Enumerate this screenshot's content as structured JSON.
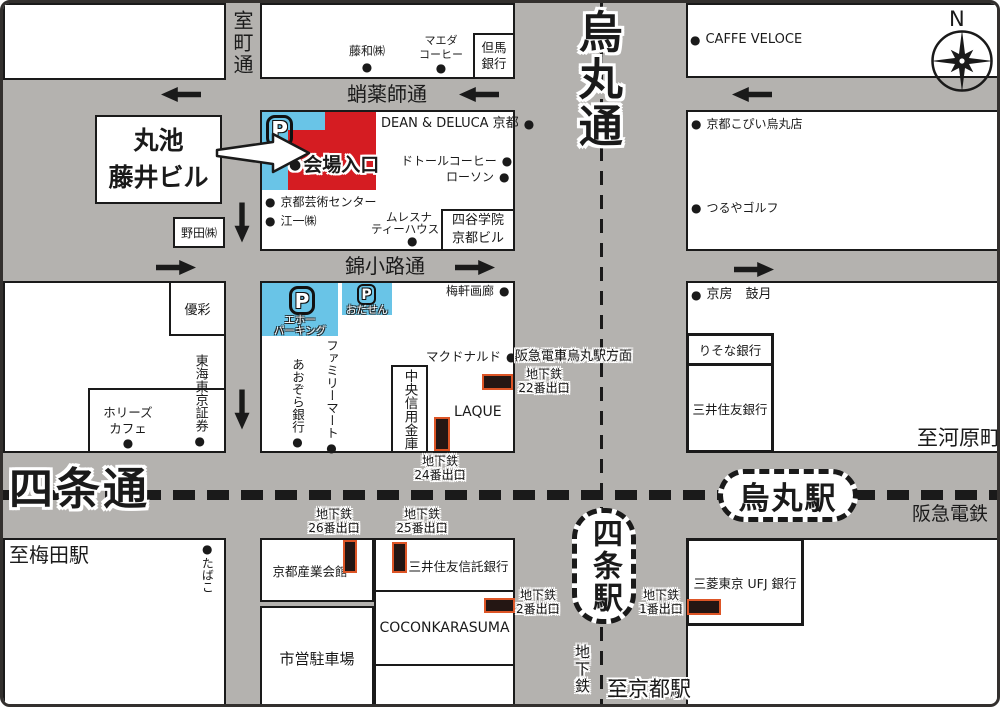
{
  "colors": {
    "road": "#b4b2af",
    "block": "#ffffff",
    "line": "#1a1a1a",
    "venue_red": "#d51c22",
    "parking_blue": "#69c4e7",
    "exit_marker_fill": "#241613",
    "exit_marker_border": "#dd5526"
  },
  "glyphs": {
    "bullet": "●",
    "parking": "P"
  },
  "compass": {
    "north": "N"
  },
  "streets": {
    "muromachi": "室町通",
    "takoyakushi": "蛸薬師通",
    "nishikikoji": "錦小路通",
    "karasuma": "烏丸通",
    "shijo": "四条通"
  },
  "railways": {
    "hankyu": "阪急電鉄",
    "hankyu_direction": "阪急電車烏丸駅方面",
    "subway": "地下鉄"
  },
  "stations": {
    "karasuma": "烏丸駅",
    "shijo": "四条駅"
  },
  "directions": {
    "to_kawaramachi": "至河原町",
    "to_umeda": "至梅田駅",
    "to_kyoto": "至京都駅"
  },
  "venue": {
    "building_l1": "丸池",
    "building_l2": "藤井ビル",
    "entrance": "会場入口"
  },
  "parkings": {
    "eho_l1": "エホー",
    "eho_l2": "パーキング",
    "odasen": "おだせん"
  },
  "subway_exits": {
    "e22": {
      "l1": "地下鉄",
      "l2": "22番出口"
    },
    "e24": {
      "l1": "地下鉄",
      "l2": "24番出口"
    },
    "e25": {
      "l1": "地下鉄",
      "l2": "25番出口"
    },
    "e26": {
      "l1": "地下鉄",
      "l2": "26番出口"
    },
    "e2": {
      "l1": "地下鉄",
      "l2": "2番出口"
    },
    "e1": {
      "l1": "地下鉄",
      "l2": "1番出口"
    }
  },
  "landmarks": {
    "towa": "藤和㈱",
    "maeda_l1": "マエダ",
    "maeda_l2": "コーヒー",
    "tajima_l1": "但馬",
    "tajima_l2": "銀行",
    "dean_deluca": "DEAN & DELUCA 京都",
    "doutor": "ドトールコーヒー",
    "lawson": "ローソン",
    "kyoto_art_center": "京都芸術センター",
    "koichi": "江一㈱",
    "mlesna_l1": "ムレスナ",
    "mlesna_l2": "ティーハウス",
    "yotsuya_l1": "四谷学院",
    "yotsuya_l2": "京都ビル",
    "noda": "野田㈱",
    "caffe_veloce": "CAFFE VELOCE",
    "kyoto_kopii": "京都こぴい烏丸店",
    "tsuruya_golf": "つるやゴルフ",
    "yusai": "優彩",
    "tokai_tokyo": "東海東京証券",
    "hollys_l1": "ホリーズ",
    "hollys_l2": "カフェ",
    "baiken_gallery": "梅軒画廊",
    "family_mart": "ファミリーマート",
    "aozora_bank": "あおぞら銀行",
    "chuo_shinkin": "中央信用金庫",
    "mcdonalds": "マクドナルド",
    "laque": "LAQUE",
    "kyobo_kogetsu": "京房　鼓月",
    "risona_bank": "りそな銀行",
    "smbc": "三井住友銀行",
    "tabako": "たばこ",
    "sangyo_kaikan": "京都産業会館",
    "city_parking": "市営駐車場",
    "smtb": "三井住友信託銀行",
    "cocon": "COCONKARASUMA",
    "ufj": "三菱東京 UFJ 銀行"
  }
}
